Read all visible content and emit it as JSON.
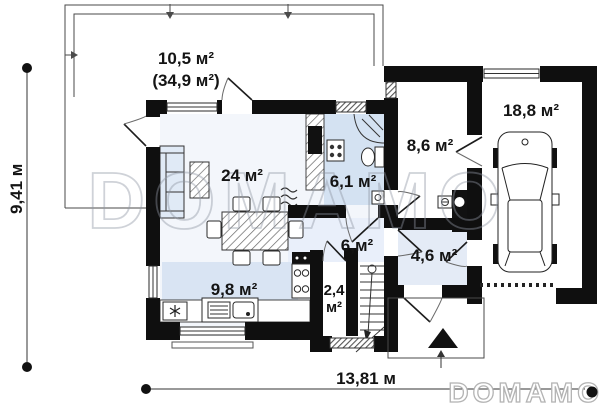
{
  "canvas": {
    "width": 614,
    "height": 409
  },
  "plan": {
    "type": "house ground floor plan",
    "watermark_center": "DOMAMO",
    "brand_logo": "DOMAMO"
  },
  "dimensions": {
    "left_vertical": "9,41 м",
    "bottom_horizontal": "13,81 м"
  },
  "rooms": {
    "terrace_area": "10,5 м²",
    "terrace_total": "(34,9 м²)",
    "living_room": "24 м²",
    "bathroom": "6,1 м²",
    "utility_room": "8,6 м²",
    "garage": "18,8 м²",
    "hall": "6,м²",
    "vestibule": "4,6 м²",
    "stair_hall_line1": "2,4",
    "stair_hall_line2": "м²",
    "kitchen": "9,8 м²"
  },
  "icons": [
    "car-icon",
    "boiler-icon",
    "stove-icon",
    "cooker-hood-icon",
    "fridge-snowflake-icon",
    "kitchen-sink-icon",
    "washing-machine-icon",
    "corner-shower-icon",
    "toilet-icon",
    "hand-sink-icon",
    "stairs-icon",
    "entrance-triangle-icon",
    "sofa-icon",
    "dining-table-icon",
    "coffee-table-icon",
    "fireplace-icon",
    "vent-grille-icon"
  ],
  "colors": {
    "wall": "#0f0f0f",
    "floor_tint": "#f3f6fb",
    "hall_tint": "#e9effa",
    "wet_room": "#d4e2f2",
    "kitchen_zone": "#d9e4f3",
    "vestibule_tint": "#e4ebf6",
    "sofa_fill": "#e0eaf6",
    "watermark_gray": "#8f96a3"
  }
}
